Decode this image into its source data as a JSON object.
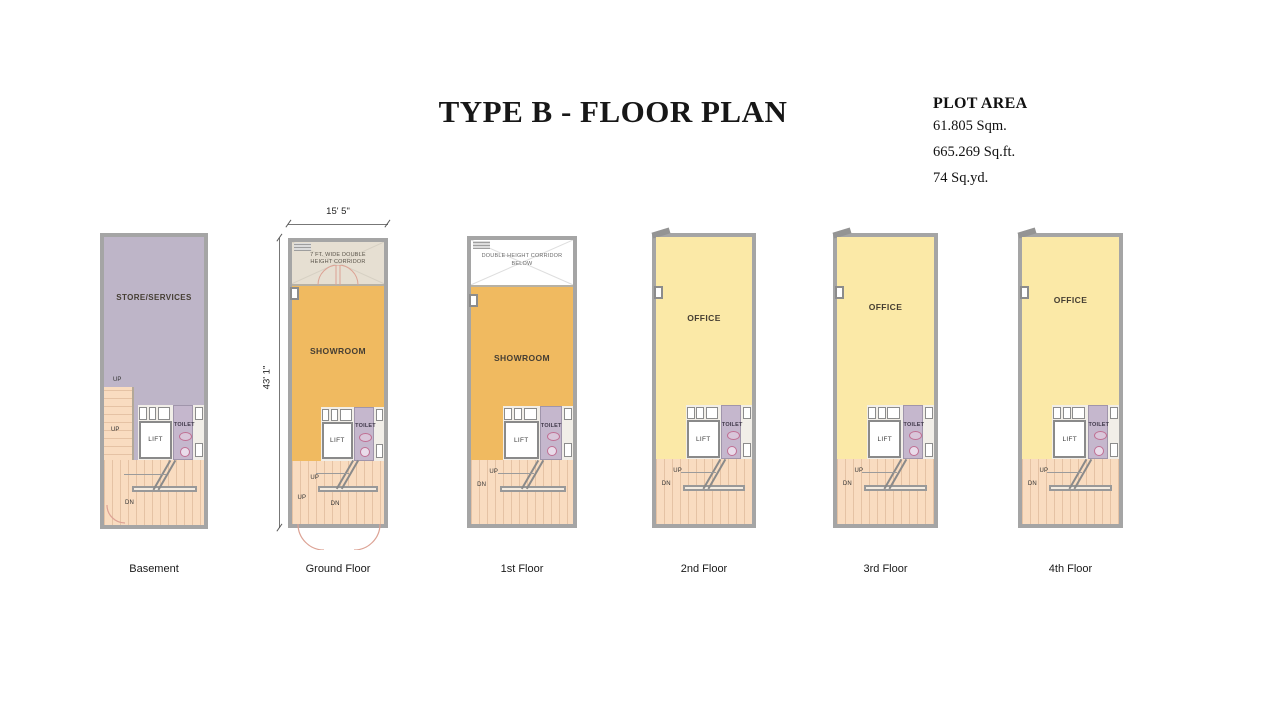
{
  "title": "TYPE B - FLOOR PLAN",
  "plot_area": {
    "heading": "PLOT AREA",
    "sqm": "61.805 Sqm.",
    "sqft": "665.269 Sq.ft.",
    "sqyd": "74 Sq.yd."
  },
  "dimensions": {
    "width": "15' 5\"",
    "depth": "43' 1\""
  },
  "labels": {
    "lift": "LIFT",
    "toilet": "TOILET",
    "up": "UP",
    "dn": "DN"
  },
  "plans": [
    {
      "name": "Basement",
      "room": "STORE/SERVICES"
    },
    {
      "name": "Ground Floor",
      "room": "SHOWROOM",
      "corridor": "7 FT. WIDE DOUBLE HEIGHT CORRIDOR"
    },
    {
      "name": "1st Floor",
      "room": "SHOWROOM",
      "corridor": "DOUBLE HEIGHT CORRIDOR BELOW"
    },
    {
      "name": "2nd Floor",
      "room": "OFFICE"
    },
    {
      "name": "3rd Floor",
      "room": "OFFICE"
    },
    {
      "name": "4th Floor",
      "room": "OFFICE"
    }
  ],
  "colors": {
    "wall": "#a5a5a5",
    "store": "#beb5c8",
    "showroom": "#f0ba60",
    "office": "#fbe9a7",
    "stairs": "#f9dcc0",
    "toilet": "#c5b7cd",
    "corridor": "#e6dfd2",
    "fixture": "#c06f93",
    "door_arc": "#dca294"
  }
}
